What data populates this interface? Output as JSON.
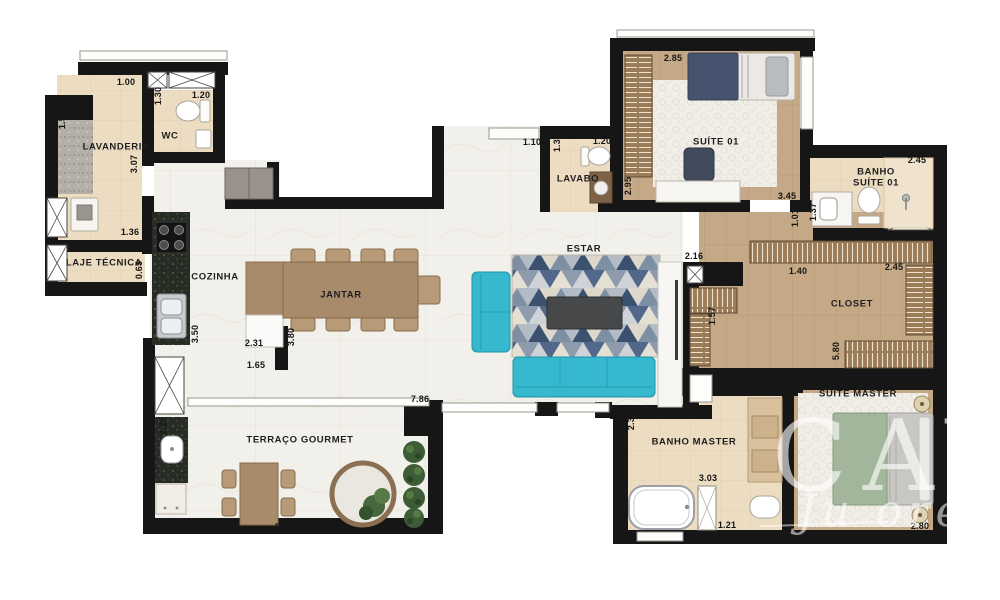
{
  "title": "Planta do apartamento",
  "rooms": {
    "lavanderia": "LAVANDERIA",
    "wc": "WC",
    "laje": "LAJE TÉCNICA",
    "cozinha": "COZINHA",
    "jantar": "JANTAR",
    "estar": "ESTAR",
    "lavabo": "LAVABO",
    "suite1": "SUÍTE 01",
    "banho_suite1_l1": "BANHO",
    "banho_suite1_l2": "SUÍTE 01",
    "closet": "CLOSET",
    "suite_master": "SUÍTE MASTER",
    "banho_master": "BANHO MASTER",
    "terraco": "TERRAÇO GOURMET"
  },
  "dims": {
    "lav_top": "1.00",
    "lav_left": "1.50",
    "lav_right": "3.07",
    "lav_bottom": "1.36",
    "wc_left": "1.30",
    "wc_top": "1.20",
    "laje_height": "0.65",
    "cozinha_len": "3.50",
    "jantar_w": "2.31",
    "jantar_h": "3.80",
    "island": "1.65",
    "entry_door": "1.10",
    "lavabo_left": "1.30",
    "lavabo_top": "1.20",
    "suite1_top": "2.85",
    "suite1_left": "2.95",
    "suite1_bottom": "3.45",
    "suite1_nub": "1.01",
    "banho1_top": "2.45",
    "banho1_left": "1.37",
    "closet_entry": "2.16",
    "closet_top": "1.40",
    "closet_top_right": "2.45",
    "closet_left": "1.57",
    "closet_len": "5.80",
    "master_left": "3.11",
    "banhom_left": "2.30",
    "banhom_w": "3.03",
    "banhom_door": "1.21",
    "master_bottom": "2.80",
    "living_w": "7.86",
    "terrace_nub": "1.84",
    "terrace_left": "2.25",
    "terrace_w": "5.24"
  },
  "watermark": {
    "brand": "CAYA",
    "script": "Ju ore"
  },
  "colors": {
    "wall": "#161616",
    "marble_floor": "#f2f0ea",
    "bath_tile": "#ecdcc2",
    "wood_floor": "#c5a987",
    "granite_dark": "#262b23",
    "granite_light": "#b4b0a7",
    "sofa_teal": "#36b8cf",
    "rug_navy": "#3b5170",
    "rug_slate": "#7d8fa3",
    "rug_cream": "#ddd8cb",
    "bed_navy": "#46536e",
    "bed_green": "#a2b69b",
    "plant_green": "#3c5c36",
    "coffee_table": "#47484a"
  }
}
